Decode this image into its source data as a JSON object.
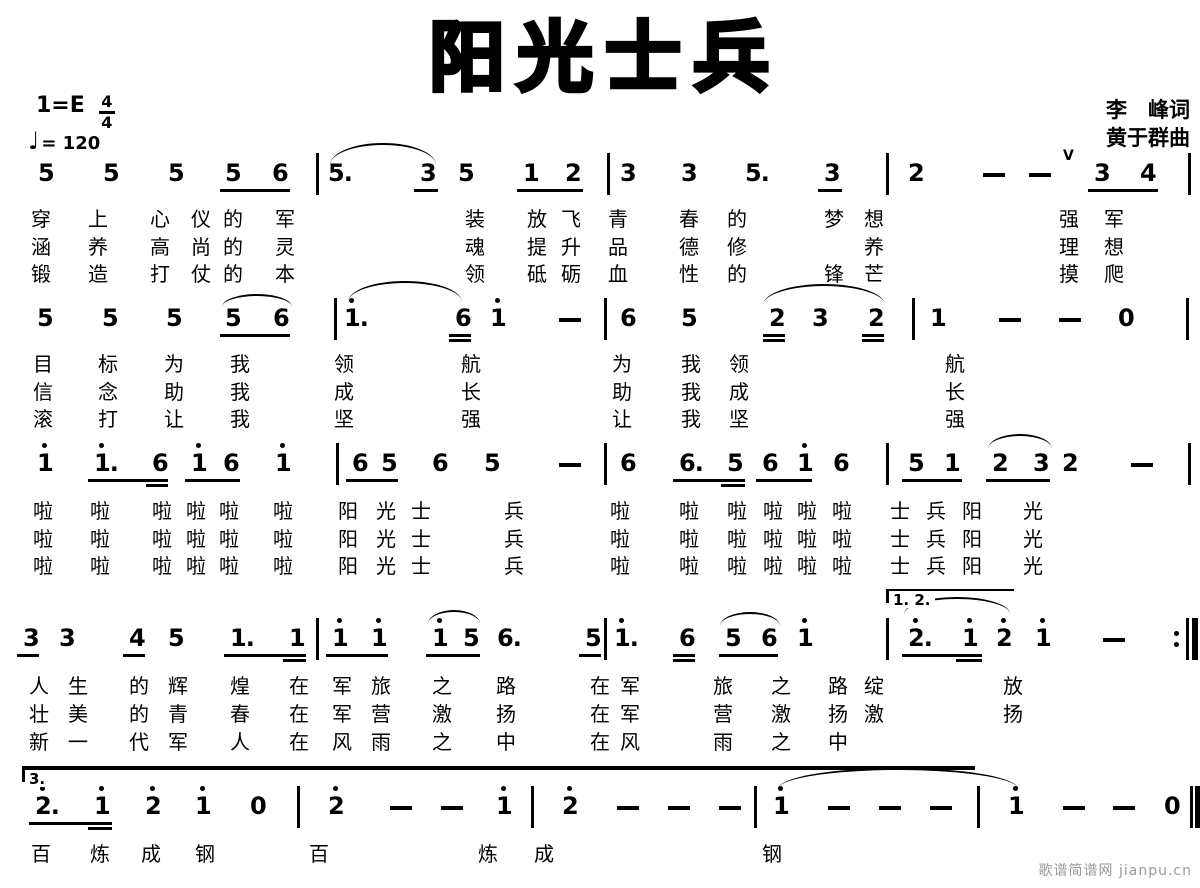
{
  "header": {
    "title": "阳光士兵",
    "key_label": "1=E",
    "time_top": "4",
    "time_bottom": "4",
    "tempo_glyph": "♩",
    "tempo_text": "= 120",
    "lyricist": "李　峰词",
    "composer": "黄于群曲"
  },
  "footer": {
    "watermark": "歌谱简谱网 jianpu.cn"
  },
  "notation_meta": {
    "ink_color": "#000000",
    "background": "#ffffff",
    "notation_type": "jianpu-numbered-notation"
  },
  "systems": [
    {
      "y": 162,
      "notes": [
        {
          "x": 38,
          "t": "5"
        },
        {
          "x": 103,
          "t": "5"
        },
        {
          "x": 168,
          "t": "5"
        },
        {
          "x": 225,
          "t": "5"
        },
        {
          "x": 272,
          "t": "6"
        },
        {
          "x": 328,
          "t": "5."
        },
        {
          "x": 420,
          "t": "3"
        },
        {
          "x": 458,
          "t": "5"
        },
        {
          "x": 523,
          "t": "1"
        },
        {
          "x": 565,
          "t": "2"
        },
        {
          "x": 620,
          "t": "3"
        },
        {
          "x": 681,
          "t": "3"
        },
        {
          "x": 745,
          "t": "5."
        },
        {
          "x": 824,
          "t": "3"
        },
        {
          "x": 908,
          "t": "2"
        },
        {
          "x": 983,
          "d": 1
        },
        {
          "x": 1029,
          "d": 1
        },
        {
          "x": 1094,
          "t": "3"
        },
        {
          "x": 1140,
          "t": "4"
        }
      ],
      "bars": [
        {
          "x": 316
        },
        {
          "x": 607
        },
        {
          "x": 886
        },
        {
          "x": 1188
        }
      ],
      "beams": [
        {
          "x1": 220,
          "x2": 290,
          "r": 0
        },
        {
          "x1": 414,
          "x2": 438,
          "r": 0
        },
        {
          "x1": 517,
          "x2": 583,
          "r": 0
        },
        {
          "x1": 818,
          "x2": 842,
          "r": 0
        },
        {
          "x1": 1088,
          "x2": 1158,
          "r": 0
        }
      ],
      "slurs": [
        {
          "x1": 330,
          "x2": 436,
          "y": 143,
          "h": 20
        }
      ],
      "marks": [
        {
          "x": 1063,
          "y": 149,
          "t": "V"
        }
      ],
      "lyrics": [
        {
          "y": 208,
          "cols": [
            31,
            88,
            150,
            191,
            223,
            275,
            465,
            527,
            561,
            608,
            679,
            727,
            824,
            864,
            1059,
            1104
          ],
          "text": "穿上心仪的军装放飞青春的梦想强军"
        },
        {
          "y": 236,
          "cols": [
            31,
            88,
            150,
            191,
            223,
            275,
            465,
            527,
            561,
            608,
            679,
            727,
            864,
            1059,
            1104
          ],
          "text": "涵养高尚的灵魂提升品德修养理想"
        },
        {
          "y": 263,
          "cols": [
            31,
            88,
            150,
            191,
            223,
            275,
            465,
            527,
            561,
            608,
            679,
            727,
            824,
            864,
            1059,
            1104
          ],
          "text": "锻造打仗的本领砥砺血性的锋芒摸爬"
        }
      ]
    },
    {
      "y": 307,
      "notes": [
        {
          "x": 37,
          "t": "5"
        },
        {
          "x": 102,
          "t": "5"
        },
        {
          "x": 166,
          "t": "5"
        },
        {
          "x": 225,
          "t": "5"
        },
        {
          "x": 273,
          "t": "6"
        },
        {
          "x": 344,
          "t": "1.",
          "hi": 1
        },
        {
          "x": 455,
          "t": "6"
        },
        {
          "x": 490,
          "t": "1",
          "hi": 1
        },
        {
          "x": 559,
          "d": 1
        },
        {
          "x": 620,
          "t": "6"
        },
        {
          "x": 681,
          "t": "5"
        },
        {
          "x": 769,
          "t": "2"
        },
        {
          "x": 812,
          "t": "3"
        },
        {
          "x": 868,
          "t": "2"
        },
        {
          "x": 930,
          "t": "1"
        },
        {
          "x": 999,
          "d": 1
        },
        {
          "x": 1059,
          "d": 1
        },
        {
          "x": 1118,
          "t": "0"
        }
      ],
      "bars": [
        {
          "x": 334
        },
        {
          "x": 604
        },
        {
          "x": 912
        },
        {
          "x": 1186
        }
      ],
      "beams": [
        {
          "x1": 220,
          "x2": 290,
          "r": 0
        },
        {
          "x1": 449,
          "x2": 471,
          "r": 0
        },
        {
          "x1": 449,
          "x2": 471,
          "r": 1
        },
        {
          "x1": 763,
          "x2": 785,
          "r": 0
        },
        {
          "x1": 763,
          "x2": 785,
          "r": 1
        },
        {
          "x1": 862,
          "x2": 884,
          "r": 0
        },
        {
          "x1": 862,
          "x2": 884,
          "r": 1
        }
      ],
      "slurs": [
        {
          "x1": 222,
          "x2": 292,
          "y": 294,
          "h": 11
        },
        {
          "x1": 348,
          "x2": 462,
          "y": 281,
          "h": 19
        },
        {
          "x1": 763,
          "x2": 885,
          "y": 284,
          "h": 19
        }
      ],
      "marks": [],
      "lyrics": [
        {
          "y": 353,
          "cols": [
            33,
            98,
            164,
            230,
            334,
            461,
            612,
            681,
            729,
            945
          ],
          "text": "目标为我领航为我领航"
        },
        {
          "y": 381,
          "cols": [
            33,
            98,
            164,
            230,
            334,
            461,
            612,
            681,
            729,
            945
          ],
          "text": "信念助我成长助我成长"
        },
        {
          "y": 408,
          "cols": [
            33,
            98,
            164,
            230,
            334,
            461,
            612,
            681,
            729,
            945
          ],
          "text": "滚打让我坚强让我坚强"
        }
      ]
    },
    {
      "y": 452,
      "notes": [
        {
          "x": 37,
          "t": "1",
          "hi": 1
        },
        {
          "x": 94,
          "t": "1.",
          "hi": 1
        },
        {
          "x": 152,
          "t": "6"
        },
        {
          "x": 191,
          "t": "1",
          "hi": 1
        },
        {
          "x": 223,
          "t": "6"
        },
        {
          "x": 275,
          "t": "1",
          "hi": 1
        },
        {
          "x": 352,
          "t": "6"
        },
        {
          "x": 381,
          "t": "5"
        },
        {
          "x": 432,
          "t": "6"
        },
        {
          "x": 484,
          "t": "5"
        },
        {
          "x": 559,
          "d": 1
        },
        {
          "x": 620,
          "t": "6"
        },
        {
          "x": 679,
          "t": "6."
        },
        {
          "x": 727,
          "t": "5"
        },
        {
          "x": 762,
          "t": "6"
        },
        {
          "x": 797,
          "t": "1",
          "hi": 1
        },
        {
          "x": 833,
          "t": "6"
        },
        {
          "x": 908,
          "t": "5"
        },
        {
          "x": 944,
          "t": "1"
        },
        {
          "x": 992,
          "t": "2"
        },
        {
          "x": 1033,
          "t": "3"
        },
        {
          "x": 1062,
          "t": "2"
        },
        {
          "x": 1131,
          "d": 1
        }
      ],
      "bars": [
        {
          "x": 336
        },
        {
          "x": 604
        },
        {
          "x": 886
        },
        {
          "x": 1188
        }
      ],
      "beams": [
        {
          "x1": 88,
          "x2": 168,
          "r": 0
        },
        {
          "x1": 146,
          "x2": 168,
          "r": 1
        },
        {
          "x1": 185,
          "x2": 240,
          "r": 0
        },
        {
          "x1": 346,
          "x2": 398,
          "r": 0
        },
        {
          "x1": 673,
          "x2": 745,
          "r": 0
        },
        {
          "x1": 721,
          "x2": 745,
          "r": 1
        },
        {
          "x1": 756,
          "x2": 812,
          "r": 0
        },
        {
          "x1": 902,
          "x2": 962,
          "r": 0
        },
        {
          "x1": 986,
          "x2": 1050,
          "r": 0
        }
      ],
      "slurs": [
        {
          "x1": 988,
          "x2": 1052,
          "y": 434,
          "h": 13
        }
      ],
      "marks": [],
      "lyrics": [
        {
          "y": 500,
          "cols": [
            33,
            90,
            152,
            186,
            219,
            273,
            338,
            376,
            411,
            504,
            610,
            679,
            727,
            763,
            797,
            832,
            890,
            926,
            962,
            1023
          ],
          "text": "啦啦啦啦啦啦阳光士兵啦啦啦啦啦啦士兵阳光"
        },
        {
          "y": 528,
          "cols": [
            33,
            90,
            152,
            186,
            219,
            273,
            338,
            376,
            411,
            504,
            610,
            679,
            727,
            763,
            797,
            832,
            890,
            926,
            962,
            1023
          ],
          "text": "啦啦啦啦啦啦阳光士兵啦啦啦啦啦啦士兵阳光"
        },
        {
          "y": 555,
          "cols": [
            33,
            90,
            152,
            186,
            219,
            273,
            338,
            376,
            411,
            504,
            610,
            679,
            727,
            763,
            797,
            832,
            890,
            926,
            962,
            1023
          ],
          "text": "啦啦啦啦啦啦阳光士兵啦啦啦啦啦啦士兵阳光"
        }
      ]
    },
    {
      "y": 627,
      "notes": [
        {
          "x": 23,
          "t": "3"
        },
        {
          "x": 59,
          "t": "3"
        },
        {
          "x": 129,
          "t": "4"
        },
        {
          "x": 168,
          "t": "5"
        },
        {
          "x": 230,
          "t": "1."
        },
        {
          "x": 289,
          "t": "1"
        },
        {
          "x": 332,
          "t": "1",
          "hi": 1
        },
        {
          "x": 371,
          "t": "1",
          "hi": 1
        },
        {
          "x": 432,
          "t": "1",
          "hi": 1
        },
        {
          "x": 463,
          "t": "5"
        },
        {
          "x": 497,
          "t": "6."
        },
        {
          "x": 585,
          "t": "5"
        },
        {
          "x": 614,
          "t": "1.",
          "hi": 1
        },
        {
          "x": 679,
          "t": "6"
        },
        {
          "x": 725,
          "t": "5"
        },
        {
          "x": 761,
          "t": "6"
        },
        {
          "x": 797,
          "t": "1",
          "hi": 1
        },
        {
          "x": 908,
          "t": "2.",
          "hi": 1
        },
        {
          "x": 962,
          "t": "1",
          "hi": 1
        },
        {
          "x": 996,
          "t": "2",
          "hi": 1
        },
        {
          "x": 1035,
          "t": "1",
          "hi": 1
        },
        {
          "x": 1103,
          "d": 1
        }
      ],
      "bars": [
        {
          "x": 316
        },
        {
          "x": 604
        },
        {
          "x": 886
        },
        {
          "x": 1186,
          "type": "repeat"
        }
      ],
      "beams": [
        {
          "x1": 17,
          "x2": 39,
          "r": 0
        },
        {
          "x1": 123,
          "x2": 145,
          "r": 0
        },
        {
          "x1": 224,
          "x2": 306,
          "r": 0
        },
        {
          "x1": 283,
          "x2": 306,
          "r": 1
        },
        {
          "x1": 326,
          "x2": 388,
          "r": 0
        },
        {
          "x1": 426,
          "x2": 480,
          "r": 0
        },
        {
          "x1": 579,
          "x2": 601,
          "r": 0
        },
        {
          "x1": 673,
          "x2": 695,
          "r": 0
        },
        {
          "x1": 673,
          "x2": 695,
          "r": 1
        },
        {
          "x1": 719,
          "x2": 778,
          "r": 0
        },
        {
          "x1": 902,
          "x2": 982,
          "r": 0
        },
        {
          "x1": 956,
          "x2": 982,
          "r": 1
        }
      ],
      "slurs": [
        {
          "x1": 428,
          "x2": 480,
          "y": 610,
          "h": 12
        },
        {
          "x1": 720,
          "x2": 780,
          "y": 612,
          "h": 12
        },
        {
          "x1": 904,
          "x2": 1010,
          "y": 597,
          "h": 15
        }
      ],
      "volta": {
        "x1": 886,
        "x2": 1014,
        "y": 589,
        "label": "1. 2."
      },
      "marks": [],
      "lyrics": [
        {
          "y": 675,
          "cols": [
            29,
            68,
            129,
            168,
            230,
            289,
            332,
            371,
            432,
            496,
            590,
            620,
            713,
            771,
            828,
            864,
            1003
          ],
          "text": "人生的辉煌在军旅之路在军旅之路绽放"
        },
        {
          "y": 703,
          "cols": [
            29,
            68,
            129,
            168,
            230,
            289,
            332,
            371,
            432,
            496,
            590,
            620,
            713,
            771,
            828,
            864,
            1003
          ],
          "text": "壮美的青春在军营激扬在军营激扬激扬"
        },
        {
          "y": 731,
          "cols": [
            29,
            68,
            129,
            168,
            230,
            289,
            332,
            371,
            432,
            496,
            590,
            620,
            713,
            771,
            828
          ],
          "text": "新一代军人在风雨之中在风雨之中"
        }
      ]
    },
    {
      "y": 795,
      "notes": [
        {
          "x": 35,
          "t": "2.",
          "hi": 1
        },
        {
          "x": 94,
          "t": "1",
          "hi": 1
        },
        {
          "x": 145,
          "t": "2",
          "hi": 1
        },
        {
          "x": 195,
          "t": "1",
          "hi": 1
        },
        {
          "x": 250,
          "t": "0"
        },
        {
          "x": 328,
          "t": "2",
          "hi": 1
        },
        {
          "x": 390,
          "d": 1
        },
        {
          "x": 441,
          "d": 1
        },
        {
          "x": 496,
          "t": "1",
          "hi": 1
        },
        {
          "x": 562,
          "t": "2",
          "hi": 1
        },
        {
          "x": 617,
          "d": 1
        },
        {
          "x": 668,
          "d": 1
        },
        {
          "x": 719,
          "d": 1
        },
        {
          "x": 773,
          "t": "1",
          "hi": 1
        },
        {
          "x": 828,
          "d": 1
        },
        {
          "x": 879,
          "d": 1
        },
        {
          "x": 930,
          "d": 1
        },
        {
          "x": 1008,
          "t": "1",
          "hi": 1
        },
        {
          "x": 1063,
          "d": 1
        },
        {
          "x": 1113,
          "d": 1
        },
        {
          "x": 1164,
          "t": "0"
        }
      ],
      "bars": [
        {
          "x": 297
        },
        {
          "x": 531
        },
        {
          "x": 754
        },
        {
          "x": 977
        },
        {
          "x": 1190,
          "type": "final"
        }
      ],
      "beams": [
        {
          "x1": 29,
          "x2": 112,
          "r": 0
        },
        {
          "x1": 88,
          "x2": 112,
          "r": 1
        }
      ],
      "slurs": [
        {
          "x1": 778,
          "x2": 1018,
          "y": 768,
          "h": 19
        }
      ],
      "volta": {
        "x1": 22,
        "x2": 975,
        "y": 766,
        "label": "3.",
        "thick": 1
      },
      "marks": [],
      "lyrics": [
        {
          "y": 843,
          "cols": [
            31,
            90,
            141,
            195,
            309,
            478,
            534,
            762
          ],
          "text": "百炼成钢百炼成钢"
        }
      ]
    }
  ]
}
